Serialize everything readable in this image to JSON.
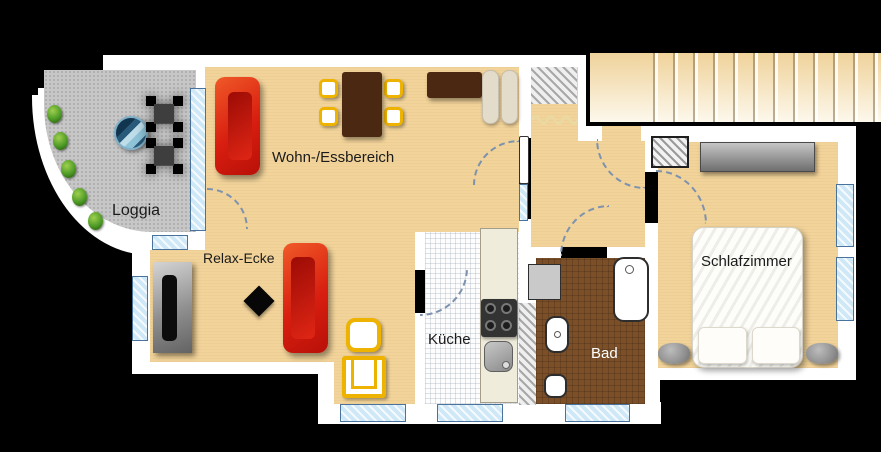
{
  "rooms": {
    "loggia": "Loggia",
    "living": "Wohn-/Essbereich",
    "relax": "Relax-Ecke",
    "kitchen": "Küche",
    "bath": "Bad",
    "bedroom": "Schlafzimmer"
  },
  "colors": {
    "wall": "#ffffff",
    "wood_floor": "#f2d49b",
    "loggia_tile": "#c7c7c7",
    "bath_tile": "#7b4f28",
    "sofa_red": "#d81e10",
    "accent_yellow": "#eeb200",
    "window_blue": "#cfe8f7",
    "door_arc": "#7d92ae"
  },
  "icons": {
    "sofa": "red lounge sofa",
    "dining_table": "dark wood table with 4 chairs",
    "tv_board": "gray lowboard with tv",
    "side_table": "black diamond side table",
    "armchair": "yellow frame armchair",
    "balcony_table": "round bistro table",
    "balcony_chair": "folding chair",
    "plant": "shrub",
    "stairs": "staircase",
    "wardrobe": "wardrobe",
    "bed": "double bed with pillows",
    "bathtub": "bathtub",
    "sink": "washbasin",
    "toilet": "wc",
    "shower": "shower / washer",
    "stove": "cooktop with 4 burners",
    "kitchen_sink": "kitchen sink"
  }
}
